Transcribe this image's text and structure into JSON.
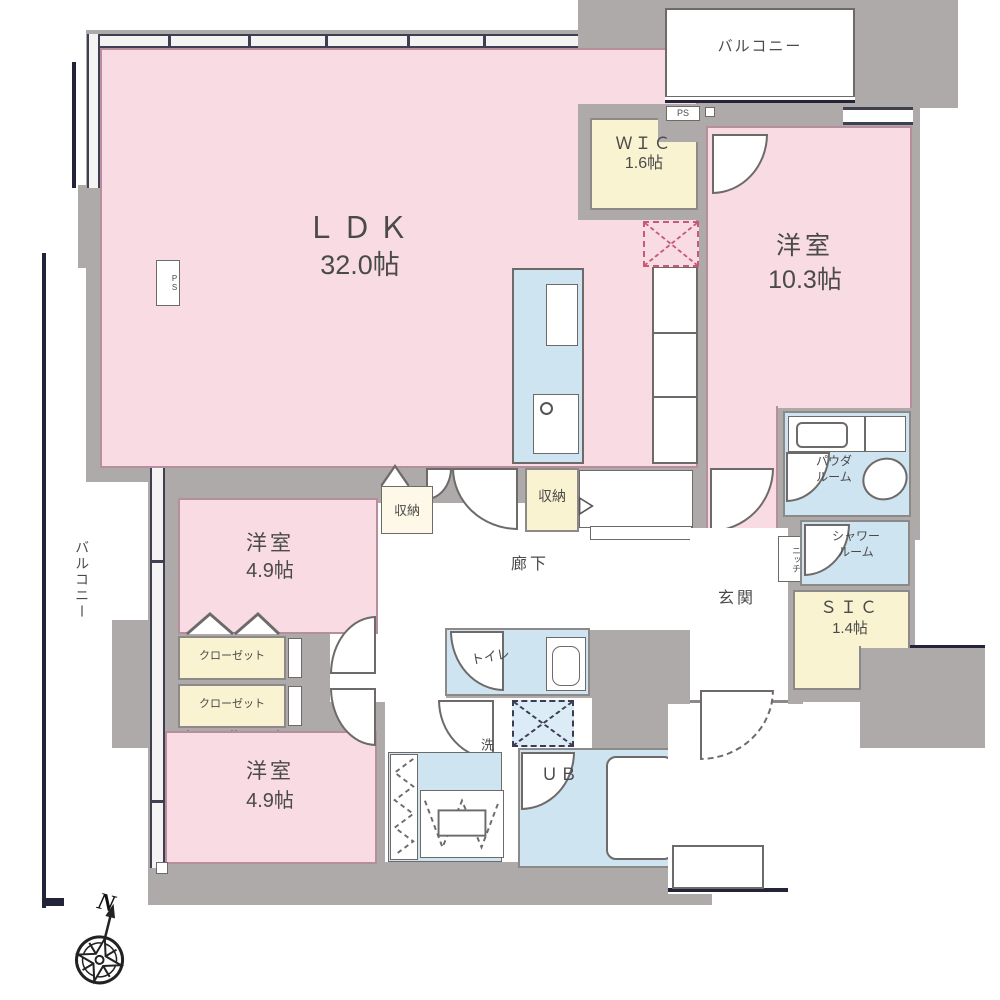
{
  "labels": {
    "ldk_name": "ＬＤＫ",
    "ldk_size": "32.0帖",
    "bedroom1_name": "洋室",
    "bedroom1_size": "10.3帖",
    "bedroom2_name": "洋室",
    "bedroom2_size": "4.9帖",
    "bedroom3_name": "洋室",
    "bedroom3_size": "4.9帖",
    "wic_name": "ＷＩＣ",
    "wic_size": "1.6帖",
    "sic_name": "ＳＩＣ",
    "sic_size": "1.4帖",
    "balcony_top": "バルコニー",
    "balcony_left": "バルコニー",
    "closet1": "クローゼット",
    "closet2": "クローゼット",
    "storage_left": "収納",
    "storage_right": "収納",
    "corridor": "廊下",
    "toilet": "トイレ",
    "washroom": "洗面脱衣室",
    "unit_bath": "ＵＢ",
    "entrance": "玄関",
    "niche": "ニッチ",
    "powder_line1": "パウダ",
    "powder_line2": "ルーム",
    "shower_line1": "シャワー",
    "shower_line2": "ルーム",
    "ps_top": "PS",
    "ps_left": "PS",
    "compass_north": "N"
  },
  "colors": {
    "room_pink": "#f8dbe3",
    "closet_yellow": "#faf3d2",
    "wet_blue": "#cfe4f1",
    "wall_gray": "#aeaaaa",
    "accent_navy": "#23233a"
  }
}
